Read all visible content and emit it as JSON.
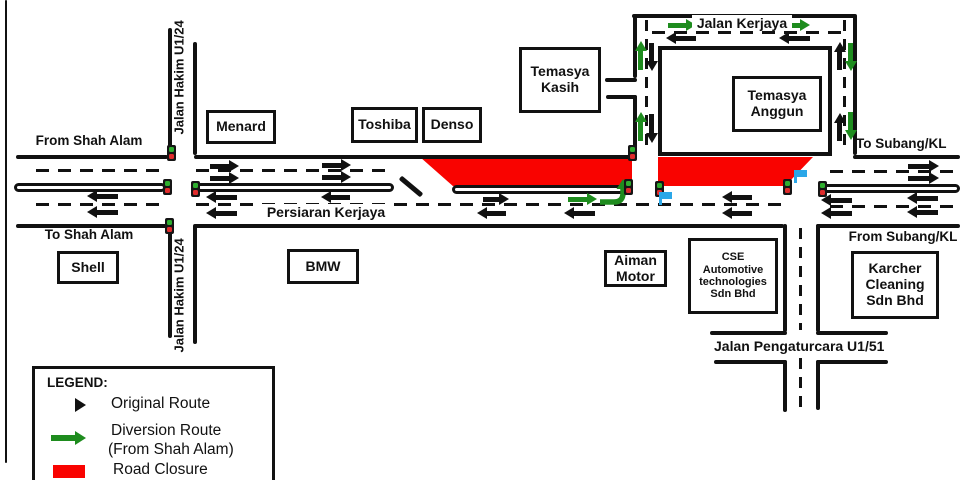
{
  "roads": {
    "persiaran_kerjaya": "Persiaran Kerjaya",
    "jalan_hakim": "Jalan Hakim U1/24",
    "jalan_kerjaya": "Jalan Kerjaya",
    "jalan_pengaturcara": "Jalan Pengaturcara U1/51"
  },
  "directions": {
    "from_shah_alam": "From Shah Alam",
    "to_shah_alam": "To Shah Alam",
    "to_subang_kl": "To Subang/KL",
    "from_subang_kl": "From Subang/KL"
  },
  "buildings": {
    "menard": "Menard",
    "toshiba": "Toshiba",
    "denso": "Denso",
    "temasya_kasih": "Temasya Kasih",
    "temasya_anggun": "Temasya Anggun",
    "shell": "Shell",
    "bmw": "BMW",
    "aiman_motor": "Aiman Motor",
    "cse": "CSE Automotive technologies Sdn Bhd",
    "karcher": "Karcher Cleaning Sdn Bhd"
  },
  "legend": {
    "title": "LEGEND:",
    "original_route": "Original Route",
    "diversion_route_line1": "Diversion Route",
    "diversion_route_line2": "(From Shah Alam)",
    "road_closure": "Road Closure"
  },
  "colors": {
    "original_route": "#111111",
    "diversion_route": "#1e8c1e",
    "road_closure": "#f90300",
    "marker_flag": "#2ba7e8",
    "signal_green": "#2fae2f",
    "signal_red": "#e02b2b"
  },
  "icons": {
    "black_arrow": "original-route-arrow-icon",
    "green_arrow": "diversion-route-arrow-icon",
    "traffic_signal": "traffic-signal-icon",
    "blue_flag": "marshal-flag-icon",
    "closure": "road-closure-swatch"
  }
}
